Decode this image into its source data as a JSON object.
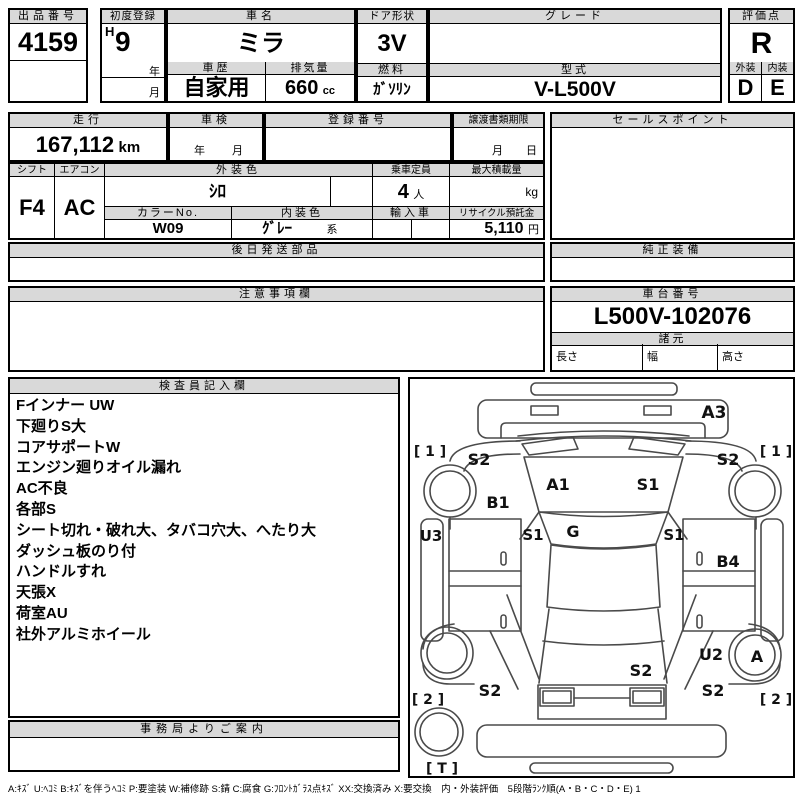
{
  "top": {
    "lot": {
      "label": "出品番号",
      "value": "4159"
    },
    "first_reg": {
      "label": "初度登録",
      "era": "H",
      "year": "9",
      "year_suffix": "年",
      "month_suffix": "月"
    },
    "name": {
      "label": "車名",
      "value": "ミラ"
    },
    "door": {
      "label": "ドア形状",
      "value": "3V"
    },
    "grade": {
      "label": "グレード",
      "value": ""
    },
    "score": {
      "label": "評価点",
      "value": "R"
    },
    "history": {
      "label": "車歴",
      "value": "自家用"
    },
    "displacement": {
      "label": "排気量",
      "value": "660",
      "unit": "cc"
    },
    "fuel": {
      "label": "燃料",
      "value": "ｶﾞｿﾘﾝ"
    },
    "model": {
      "label": "型式",
      "value": "V-L500V"
    },
    "exterior": {
      "label": "外装",
      "value": "D"
    },
    "interior": {
      "label": "内装",
      "value": "E"
    }
  },
  "mid": {
    "mileage": {
      "label": "走行",
      "value": "167,112",
      "unit": "km"
    },
    "inspection": {
      "label": "車検",
      "year": "年",
      "month": "月"
    },
    "reg_no": {
      "label": "登録番号",
      "value": ""
    },
    "transfer": {
      "label": "譲渡書類期限",
      "month": "月",
      "day": "日"
    },
    "sales_point": {
      "label": "セールスポイント",
      "value": ""
    },
    "shift": {
      "label": "シフト",
      "value": "F4"
    },
    "aircon": {
      "label": "エアコン",
      "value": "AC"
    },
    "ext_color": {
      "label": "外装色",
      "value": "ｼﾛ"
    },
    "capacity": {
      "label": "乗車定員",
      "value": "4",
      "unit": "人"
    },
    "max_load": {
      "label": "最大積載量",
      "value": "",
      "unit": "kg"
    },
    "color_no": {
      "label": "カラーNo.",
      "value": "W09"
    },
    "int_color": {
      "label": "内装色",
      "value": "ｸﾞﾚｰ",
      "suffix": "系"
    },
    "import_car": {
      "label": "輸入車",
      "value": ""
    },
    "recycle": {
      "label": "リサイクル預託金",
      "value": "5,110",
      "unit": "円"
    },
    "later_parts": {
      "label": "後日発送部品",
      "value": ""
    },
    "genuine_equip": {
      "label": "純正装備",
      "value": ""
    }
  },
  "notice": {
    "label": "注意事項欄",
    "value": ""
  },
  "chassis": {
    "label": "車台番号",
    "value": "L500V-102076",
    "spec_label": "諸元",
    "length_label": "長さ",
    "width_label": "幅",
    "height_label": "高さ"
  },
  "inspector": {
    "label": "検査員記入欄",
    "notes": [
      "Fインナー UW",
      "下廻りS大",
      "コアサポートW",
      "エンジン廻りオイル漏れ",
      "AC不良",
      "各部S",
      "シート切れ・破れ大、タバコ穴大、へたり大",
      "ダッシュ板のり付",
      "ハンドルすれ",
      "天張X",
      "荷室AU",
      "社外アルミホイール"
    ]
  },
  "office": {
    "label": "事務局よりご案内",
    "value": ""
  },
  "diagram": {
    "labels": {
      "a3": "A3",
      "bracket_front_left": "[ 1 ]",
      "bracket_front_right": "[ 1 ]",
      "s2_front_left": "S2",
      "s2_front_right": "S2",
      "b1": "B1",
      "a1": "A1",
      "s1_windshield": "S1",
      "u3": "U3",
      "s1_cowl_left": "S1",
      "g_cowl": "G",
      "s1_cowl_right": "S1",
      "b4": "B4",
      "u2": "U2",
      "a_rear_wheel": "A",
      "s2_rear_center": "S2",
      "s2_rear_left": "S2",
      "s2_rear_right": "S2",
      "bracket_rear_left": "[ 2 ]",
      "bracket_rear_right": "[ 2 ]",
      "bracket_spare": "[ T ]"
    }
  },
  "legend": "A:ｷｽﾞ U:ﾍｺﾐ B:ｷｽﾞを伴うﾍｺﾐ P:要塗装 W:補修跡 S:錆 C:腐食 G:ﾌﾛﾝﾄｶﾞﾗｽ点ｷｽﾞ XX:交換済み X:要交換　内・外装評価　5段階ﾗﾝｸ順(A・B・C・D・E) 1",
  "colors": {
    "header_bg": "#d9d9d9",
    "border": "#000000",
    "diagram_stroke": "#4a4a4a"
  }
}
